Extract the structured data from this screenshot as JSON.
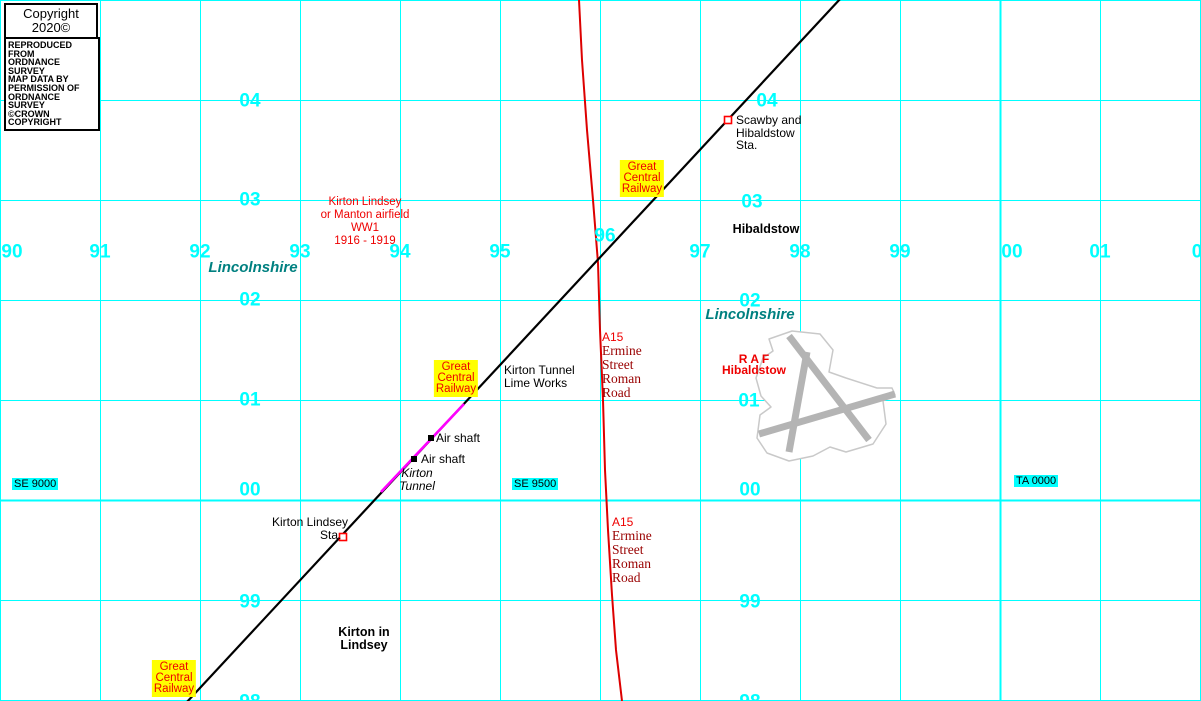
{
  "colors": {
    "grid": "#00ffff",
    "teal": "#008080",
    "red": "#ee0000",
    "dark-red": "#990000",
    "yellow": "#ffff00",
    "railway": "#000000",
    "tunnel": "#ff00ff",
    "road": "#dd0000",
    "runway": "#b4b4b4",
    "airfield-outline": "#c9c9c9",
    "marker-red": "#ff0000"
  },
  "copyright": {
    "box1": {
      "line1": "Copyright 2020©",
      "line2": "KeymapsGB"
    },
    "box2": {
      "lines": [
        "REPRODUCED FROM",
        "ORDNANCE SURVEY",
        "MAP DATA BY",
        "PERMISSION OF",
        "ORDNANCE SURVEY",
        "©CROWN COPYRIGHT"
      ]
    }
  },
  "grid": {
    "spacing": 100,
    "width": 1201,
    "height": 701,
    "thick_easting_x": 1000,
    "thick_northing_y": 500,
    "eastings": [
      {
        "label": "90",
        "x": 12,
        "y": 252
      },
      {
        "label": "91",
        "x": 100,
        "y": 252
      },
      {
        "label": "92",
        "x": 200,
        "y": 252
      },
      {
        "label": "93",
        "x": 300,
        "y": 252
      },
      {
        "label": "94",
        "x": 400,
        "y": 252
      },
      {
        "label": "95",
        "x": 500,
        "y": 252
      },
      {
        "label": "96",
        "x": 605,
        "y": 236
      },
      {
        "label": "97",
        "x": 700,
        "y": 252
      },
      {
        "label": "98",
        "x": 800,
        "y": 252
      },
      {
        "label": "99",
        "x": 900,
        "y": 252
      },
      {
        "label": "00",
        "x": 1012,
        "y": 252
      },
      {
        "label": "01",
        "x": 1100,
        "y": 252
      },
      {
        "label": "0",
        "x": 1197,
        "y": 252
      }
    ],
    "northings": [
      {
        "label": "04",
        "x": 250,
        "y": 101
      },
      {
        "label": "03",
        "x": 250,
        "y": 200
      },
      {
        "label": "02",
        "x": 250,
        "y": 300
      },
      {
        "label": "01",
        "x": 250,
        "y": 400
      },
      {
        "label": "00",
        "x": 250,
        "y": 490
      },
      {
        "label": "99",
        "x": 250,
        "y": 602
      },
      {
        "label": "98",
        "x": 250,
        "y": 702
      },
      {
        "label": "04",
        "x": 767,
        "y": 101
      },
      {
        "label": "03",
        "x": 752,
        "y": 202
      },
      {
        "label": "02",
        "x": 750,
        "y": 301
      },
      {
        "label": "01",
        "x": 749,
        "y": 401
      },
      {
        "label": "00",
        "x": 750,
        "y": 490
      },
      {
        "label": "99",
        "x": 750,
        "y": 602
      },
      {
        "label": "98",
        "x": 750,
        "y": 702
      }
    ]
  },
  "labels": [
    {
      "name": "airfield-history-label",
      "x": 365,
      "y": 196,
      "anchor": "center",
      "cls": "lbl-red-center",
      "lines": [
        "Kirton Lindsey",
        "or Manton airfield",
        "WW1",
        "1916 - 1919"
      ]
    },
    {
      "name": "lincolnshire-label-1",
      "x": 253,
      "y": 260,
      "anchor": "center",
      "cls": "lbl-teal",
      "lines": [
        "Lincolnshire"
      ]
    },
    {
      "name": "lincolnshire-label-2",
      "x": 750,
      "y": 307,
      "anchor": "center",
      "cls": "lbl-teal",
      "lines": [
        "Lincolnshire"
      ]
    },
    {
      "name": "great-central-railway-label-1",
      "x": 642,
      "y": 160,
      "anchor": "center",
      "cls": "lbl-gcr",
      "lines": [
        "Great",
        "Central",
        "Railway"
      ]
    },
    {
      "name": "great-central-railway-label-2",
      "x": 456,
      "y": 360,
      "anchor": "center",
      "cls": "lbl-gcr",
      "lines": [
        "Great",
        "Central",
        "Railway"
      ]
    },
    {
      "name": "great-central-railway-label-3",
      "x": 174,
      "y": 660,
      "anchor": "center",
      "cls": "lbl-gcr",
      "lines": [
        "Great",
        "Central",
        "Railway"
      ]
    },
    {
      "name": "scawby-station-label",
      "x": 736,
      "y": 114,
      "anchor": "left",
      "cls": "",
      "lines": [
        "Scawby and",
        "Hibaldstow",
        "Sta."
      ]
    },
    {
      "name": "hibaldstow-label",
      "x": 766,
      "y": 223,
      "anchor": "center",
      "cls": "lbl-black-bold",
      "lines": [
        "Hibaldstow"
      ]
    },
    {
      "name": "kirton-tunnel-lime-works-label",
      "x": 504,
      "y": 364,
      "anchor": "left",
      "cls": "",
      "lines": [
        "Kirton Tunnel",
        "Lime Works"
      ]
    },
    {
      "name": "a15-ermine-street-label-1",
      "x": 602,
      "y": 331,
      "anchor": "left",
      "cls": "",
      "lines": [
        {
          "t": "A15",
          "c": "line-redsans"
        },
        {
          "t": "Ermine",
          "c": "line-serif"
        },
        {
          "t": "Street",
          "c": "line-serif"
        },
        {
          "t": "Roman",
          "c": "line-serif"
        },
        {
          "t": "Road",
          "c": "line-serif"
        }
      ]
    },
    {
      "name": "a15-ermine-street-label-2",
      "x": 612,
      "y": 516,
      "anchor": "left",
      "cls": "",
      "lines": [
        {
          "t": "A15",
          "c": "line-redsans"
        },
        {
          "t": "Ermine",
          "c": "line-serif"
        },
        {
          "t": "Street",
          "c": "line-serif"
        },
        {
          "t": "Roman",
          "c": "line-serif"
        },
        {
          "t": "Road",
          "c": "line-serif"
        }
      ]
    },
    {
      "name": "raf-hibaldstow-label",
      "x": 754,
      "y": 354,
      "anchor": "center",
      "cls": "lbl-raf",
      "lines": [
        "R A F",
        "Hibaldstow"
      ]
    },
    {
      "name": "air-shaft-label-1",
      "x": 436,
      "y": 432,
      "anchor": "left",
      "cls": "",
      "lines": [
        "Air shaft"
      ]
    },
    {
      "name": "air-shaft-label-2",
      "x": 421,
      "y": 453,
      "anchor": "left",
      "cls": "",
      "lines": [
        "Air shaft"
      ]
    },
    {
      "name": "kirton-tunnel-label",
      "x": 417,
      "y": 467,
      "anchor": "center",
      "cls": "lbl-italic",
      "lines": [
        "Kirton",
        "Tunnel"
      ]
    },
    {
      "name": "kirton-lindsey-station-label",
      "x": 348,
      "y": 516,
      "anchor": "right",
      "cls": "",
      "lines": [
        "Kirton Lindsey",
        "Sta.  "
      ]
    },
    {
      "name": "kirton-in-lindsey-label",
      "x": 364,
      "y": 626,
      "anchor": "center",
      "cls": "lbl-black-bold",
      "lines": [
        "Kirton in",
        "Lindsey"
      ]
    },
    {
      "name": "gridref-se-9000",
      "x": 12,
      "y": 478,
      "anchor": "left",
      "cls": "lbl-gridref",
      "lines": [
        "SE 9000"
      ]
    },
    {
      "name": "gridref-se-9500",
      "x": 512,
      "y": 478,
      "anchor": "left",
      "cls": "lbl-gridref",
      "lines": [
        "SE 9500"
      ]
    },
    {
      "name": "gridref-ta-0000",
      "x": 1014,
      "y": 475,
      "anchor": "left",
      "cls": "lbl-gridref",
      "lines": [
        "TA 0000"
      ]
    }
  ]
}
